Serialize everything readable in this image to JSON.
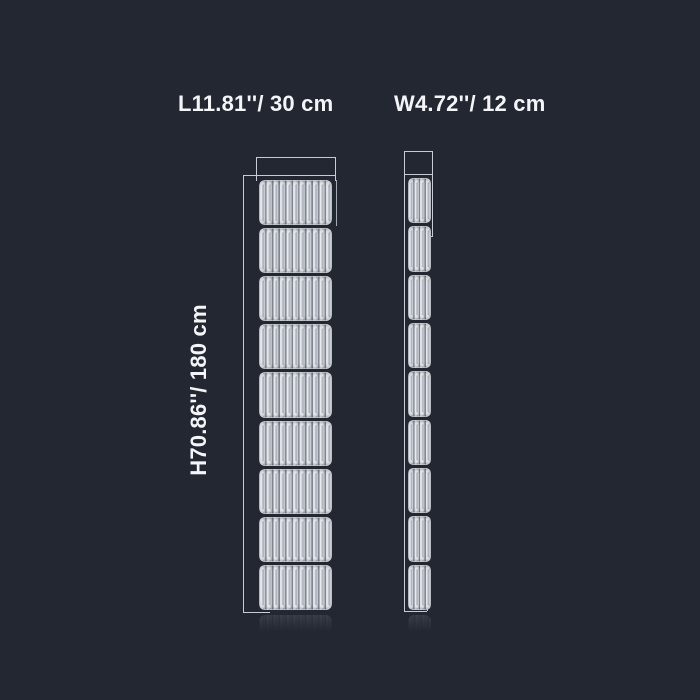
{
  "colors": {
    "bg": "#232732",
    "text": "#f4f5f8",
    "wire": "#c6ccd6",
    "rib-dark": "#7f8691",
    "rib-light": "#eff1f4",
    "rib-mid": "#aeb3bd"
  },
  "labels": {
    "length": "L11.81''/ 30 cm",
    "width": "W4.72''/ 12 cm",
    "height": "H70.86''/ 180 cm"
  },
  "views": {
    "front": {
      "segments": 9,
      "ribs_per_segment": 11
    },
    "side": {
      "segments": 9,
      "ribs_per_segment": 4
    }
  }
}
